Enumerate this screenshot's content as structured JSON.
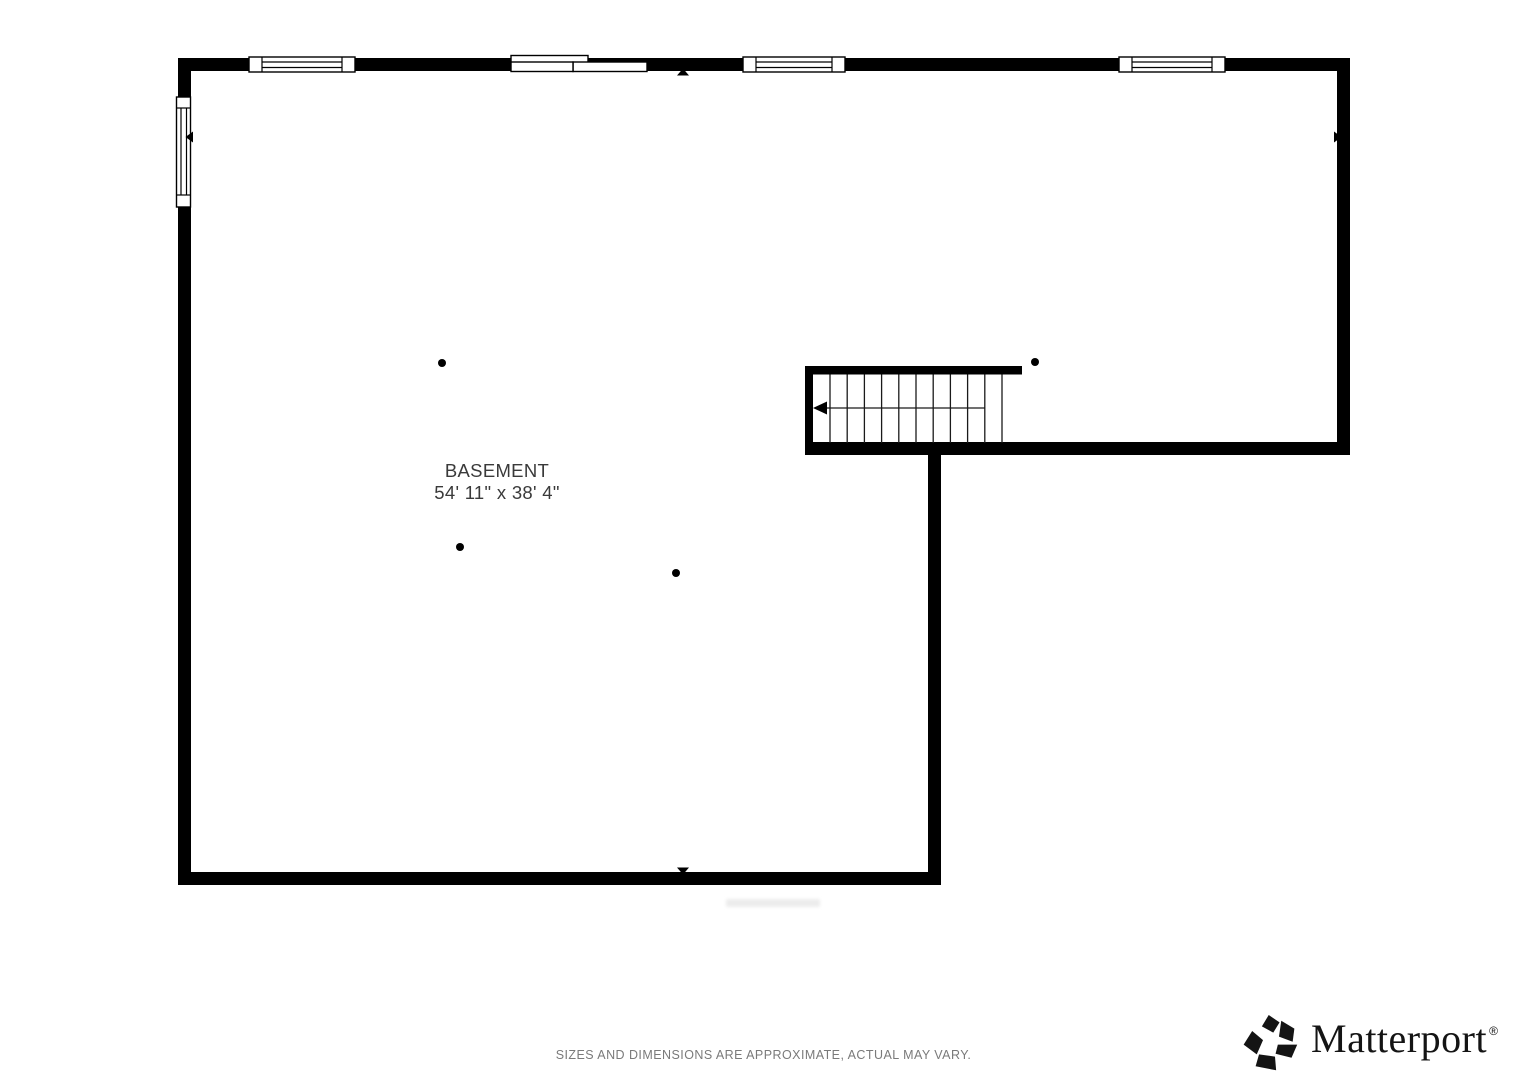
{
  "page": {
    "width": 1527,
    "height": 1080,
    "background": "#ffffff"
  },
  "floorplan": {
    "room_label": "BASEMENT",
    "room_dimensions": "54' 11\" x 38' 4\"",
    "wall_color": "#000000",
    "label_color": "#3a3a3a",
    "columns": [
      {
        "x": 442,
        "y": 363
      },
      {
        "x": 460,
        "y": 547
      },
      {
        "x": 676,
        "y": 573
      },
      {
        "x": 1035,
        "y": 362
      }
    ],
    "stairs": {
      "treads": 11,
      "direction_arrow": "left"
    },
    "windows": {
      "top_wall_windows": 3,
      "left_wall_windows": 1,
      "sliding_doors": 1
    }
  },
  "footer": {
    "disclaimer": "SIZES AND DIMENSIONS ARE APPROXIMATE, ACTUAL MAY VARY.",
    "disclaimer_color": "#7a7a7a"
  },
  "branding": {
    "logo_text": "Matterport",
    "registered_mark": "®",
    "logo_color": "#141414"
  }
}
